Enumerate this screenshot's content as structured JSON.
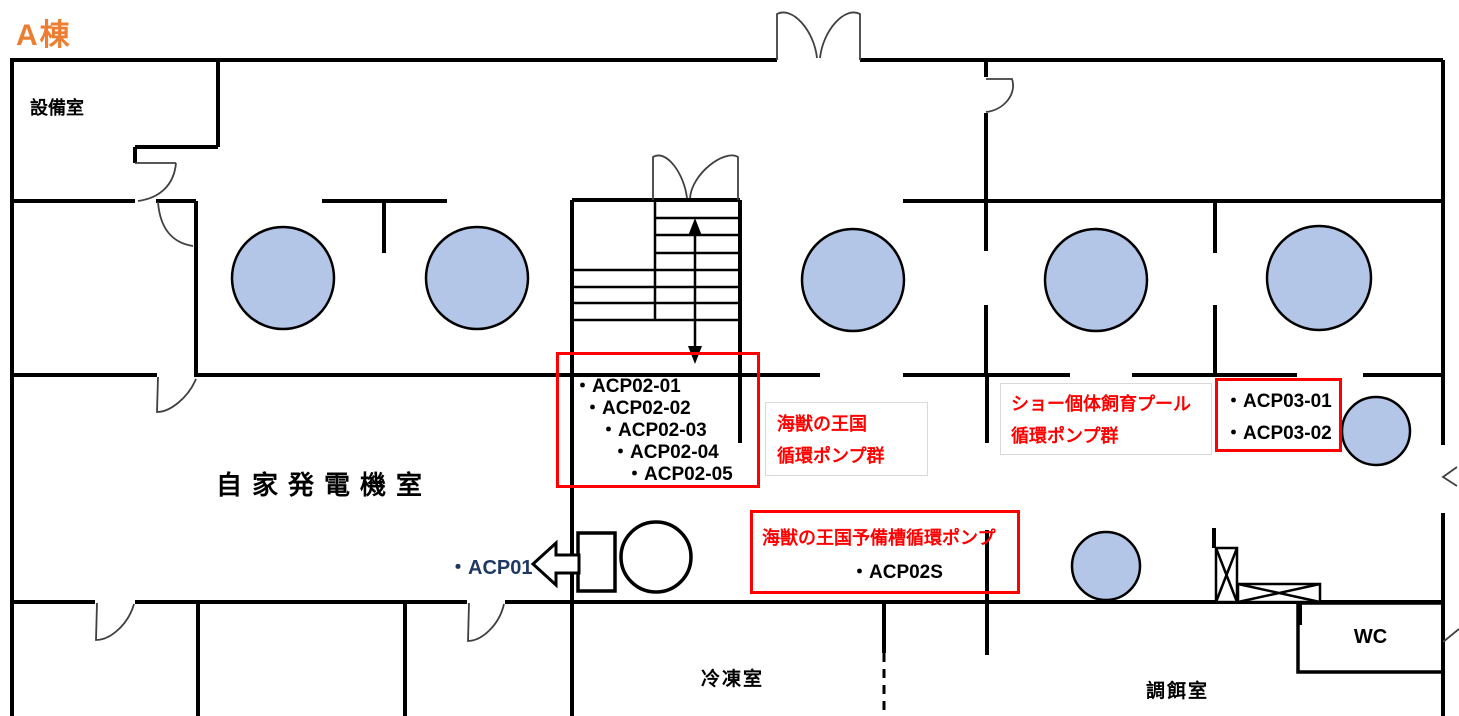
{
  "page": {
    "title": "A棟"
  },
  "colors": {
    "accent_orange": "#ED7D31",
    "pool_fill": "#B4C6E7",
    "highlight_red": "#FF0000",
    "acp01_blue": "#1F3864",
    "label_box_border": "#D9D9D9",
    "wall_black": "#000000"
  },
  "rooms": {
    "equipment": "設備室",
    "generator": "自家発電機室",
    "freezer": "冷凍室",
    "feed_prep": "調餌室",
    "wc": "WC"
  },
  "pumps": {
    "acp01": "・ACP01",
    "acp02_group": {
      "items": [
        "・ACP02-01",
        "・ACP02-02",
        "・ACP02-03",
        "・ACP02-04",
        "・ACP02-05"
      ],
      "caption_line1": "海獣の王国",
      "caption_line2": "循環ポンプ群"
    },
    "show_pool_group": {
      "caption_line1": "ショー個体飼育プール",
      "caption_line2": "循環ポンプ群"
    },
    "acp03_group": {
      "items": [
        "・ACP03-01",
        "・ACP03-02"
      ]
    },
    "reserve_pump": {
      "caption": "海獣の王国予備槽循環ポンプ",
      "item": "・ACP02S"
    }
  }
}
